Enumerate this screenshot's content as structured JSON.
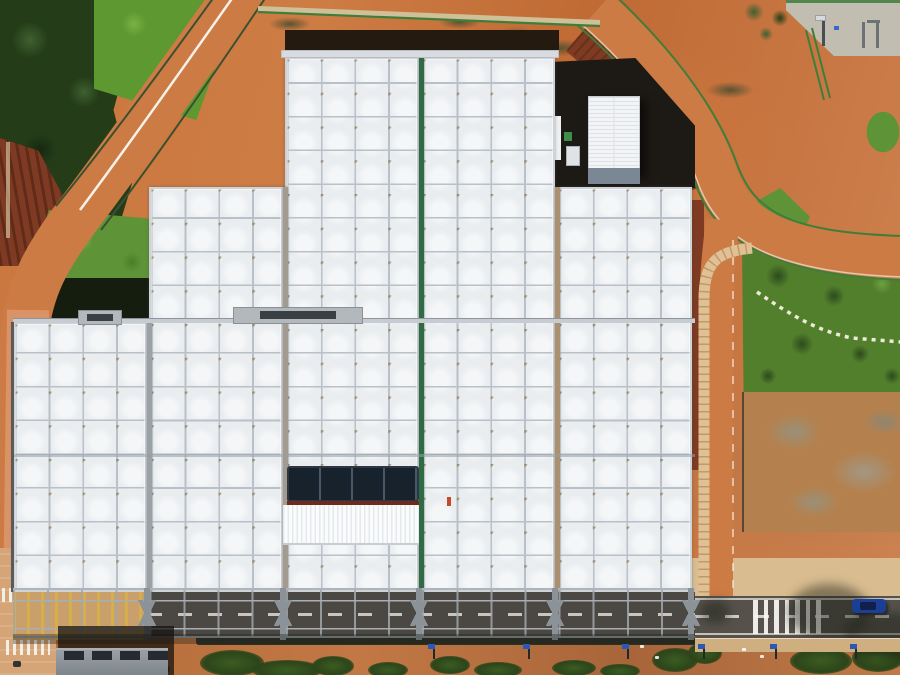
{
  "scene": {
    "description": "Aerial top-down drone photo of a large industrial facility with a stepped white grid-panel roof, surrounded by orange dirt roads, green lawns, a pine forest, landscaped garden with stepping-stone path, and a street with zebra crossing at the bottom",
    "elements": [
      "warehouse with white gridded skylight roof",
      "green and tan roof divider strips",
      "rooftop solar panel array",
      "white corrugated roof patch",
      "small white service building",
      "steel canopy truss along south facade",
      "orange dirt ring road with green fences",
      "pine forest",
      "lawns and garden with stepping-stone path",
      "underground ramp structure",
      "zebra crossing and blue car",
      "solar street lamps"
    ]
  },
  "palette": {
    "dirt": "#c9773f",
    "dirtDark": "#b05e2c",
    "dirtLight": "#d98d55",
    "roadDirt": "#cd7b45",
    "brickRoad": "#dd9a6e",
    "mulch": "#7e3a22",
    "mulchDark": "#55250f",
    "forest": "#243d18",
    "forestLight": "#3f6030",
    "forestDark": "#16280f",
    "grassBright": "#5d9830",
    "grass": "#5f9338",
    "gardenGreen": "#527f2c",
    "treeDark": "#2c4a1d",
    "fenceGreen": "#3f7d3a",
    "fenceDark": "#3c5030",
    "roofCell": "#e9edf0",
    "roofLine": "#b9c0c7",
    "roofNode": "#9b8769",
    "roofFrame": "#ced3d8",
    "greenStrip": "#2e6b45",
    "tanStrip": "#ab9070",
    "grayStrip": "#9aa1a7",
    "brownStrip": "#a39a90",
    "darkPanel": "#18222c",
    "panelDivider": "#46586a",
    "corrWhite": "#fafbfd",
    "asphalt": "#4b4742",
    "asphaltLight": "#56524b",
    "truss": "#a0a6ac",
    "trussDark": "#8b9298",
    "paveTan": "#d9bd90",
    "paveSand": "#d6a577",
    "concrete": "#c2bdb1",
    "hedge": "#2c3124",
    "shadow": "rgba(18,17,14,0.72)",
    "whiteRoof": "#f2f4f6",
    "ridge": "#dde1e5",
    "buildingBase": "#7b8794",
    "grayRoof": "#8b9196",
    "ventDark": "#272b2f",
    "lampBlue": "#2b57b5",
    "carBlue": "#1c3f96",
    "yellowMark": "#d7aa3c",
    "darkBand": "#241a10",
    "yardDark": "#1d1915",
    "stoneWhite": "#efe9da",
    "walkTan": "#e0c094"
  },
  "building": {
    "bottom": 592,
    "sections": [
      {
        "name": "left",
        "x": 13,
        "w": 134,
        "top": 322
      },
      {
        "name": "mid-left",
        "x": 149,
        "w": 134,
        "top": 187
      },
      {
        "name": "center-left",
        "x": 285,
        "w": 134,
        "top": 57
      },
      {
        "name": "center-right",
        "x": 421,
        "w": 134,
        "top": 57
      },
      {
        "name": "right",
        "x": 557,
        "w": 135,
        "top": 187
      }
    ],
    "dividers": [
      {
        "x": 147,
        "top": 322,
        "colorKey": "grayStrip"
      },
      {
        "x": 283,
        "top": 187,
        "colorKey": "brownStrip"
      },
      {
        "x": 419,
        "top": 57,
        "colorKey": "greenStrip"
      },
      {
        "x": 555,
        "top": 187,
        "colorKey": "tanStrip"
      }
    ],
    "ahus": [
      {
        "x": 78,
        "y": 310,
        "w": 44,
        "h": 15
      },
      {
        "x": 233,
        "y": 307,
        "w": 130,
        "h": 17
      }
    ]
  },
  "objects": {
    "pylons": [
      147,
      283,
      419,
      555,
      691
    ],
    "lamps": [
      433,
      528,
      627,
      703,
      775,
      855
    ],
    "vents": [
      64,
      92,
      120,
      148
    ],
    "zebra": {
      "x": 753,
      "y": 600,
      "h": 34,
      "count": 7,
      "stripeW": 4.5,
      "gap": 6
    },
    "padPosts": [
      {
        "x": 862,
        "y": 22,
        "w": 3,
        "h": 26
      },
      {
        "x": 876,
        "y": 22,
        "w": 3,
        "h": 26
      },
      {
        "x": 867,
        "y": 20,
        "w": 13,
        "h": 3
      }
    ],
    "bushes": [
      {
        "x": 200,
        "y": 650,
        "w": 64,
        "h": 26
      },
      {
        "x": 252,
        "y": 660,
        "w": 70,
        "h": 20
      },
      {
        "x": 312,
        "y": 656,
        "w": 42,
        "h": 20
      },
      {
        "x": 368,
        "y": 662,
        "w": 40,
        "h": 16
      },
      {
        "x": 430,
        "y": 656,
        "w": 40,
        "h": 18
      },
      {
        "x": 474,
        "y": 662,
        "w": 48,
        "h": 16
      },
      {
        "x": 552,
        "y": 660,
        "w": 44,
        "h": 16
      },
      {
        "x": 600,
        "y": 664,
        "w": 40,
        "h": 14
      },
      {
        "x": 652,
        "y": 648,
        "w": 46,
        "h": 24
      },
      {
        "x": 688,
        "y": 642,
        "w": 34,
        "h": 22
      },
      {
        "x": 790,
        "y": 648,
        "w": 62,
        "h": 26
      },
      {
        "x": 852,
        "y": 644,
        "w": 52,
        "h": 28
      },
      {
        "x": 140,
        "y": 662,
        "w": 30,
        "h": 14
      }
    ],
    "treeShadows": [
      {
        "x": 788,
        "y": 584,
        "w": 82,
        "h": 56
      },
      {
        "x": 844,
        "y": 612,
        "w": 90,
        "h": 46
      },
      {
        "x": 700,
        "y": 600,
        "w": 30,
        "h": 24
      }
    ],
    "debris": [
      {
        "x": 640,
        "y": 645
      },
      {
        "x": 655,
        "y": 656
      },
      {
        "x": 742,
        "y": 648
      },
      {
        "x": 760,
        "y": 655
      }
    ]
  }
}
